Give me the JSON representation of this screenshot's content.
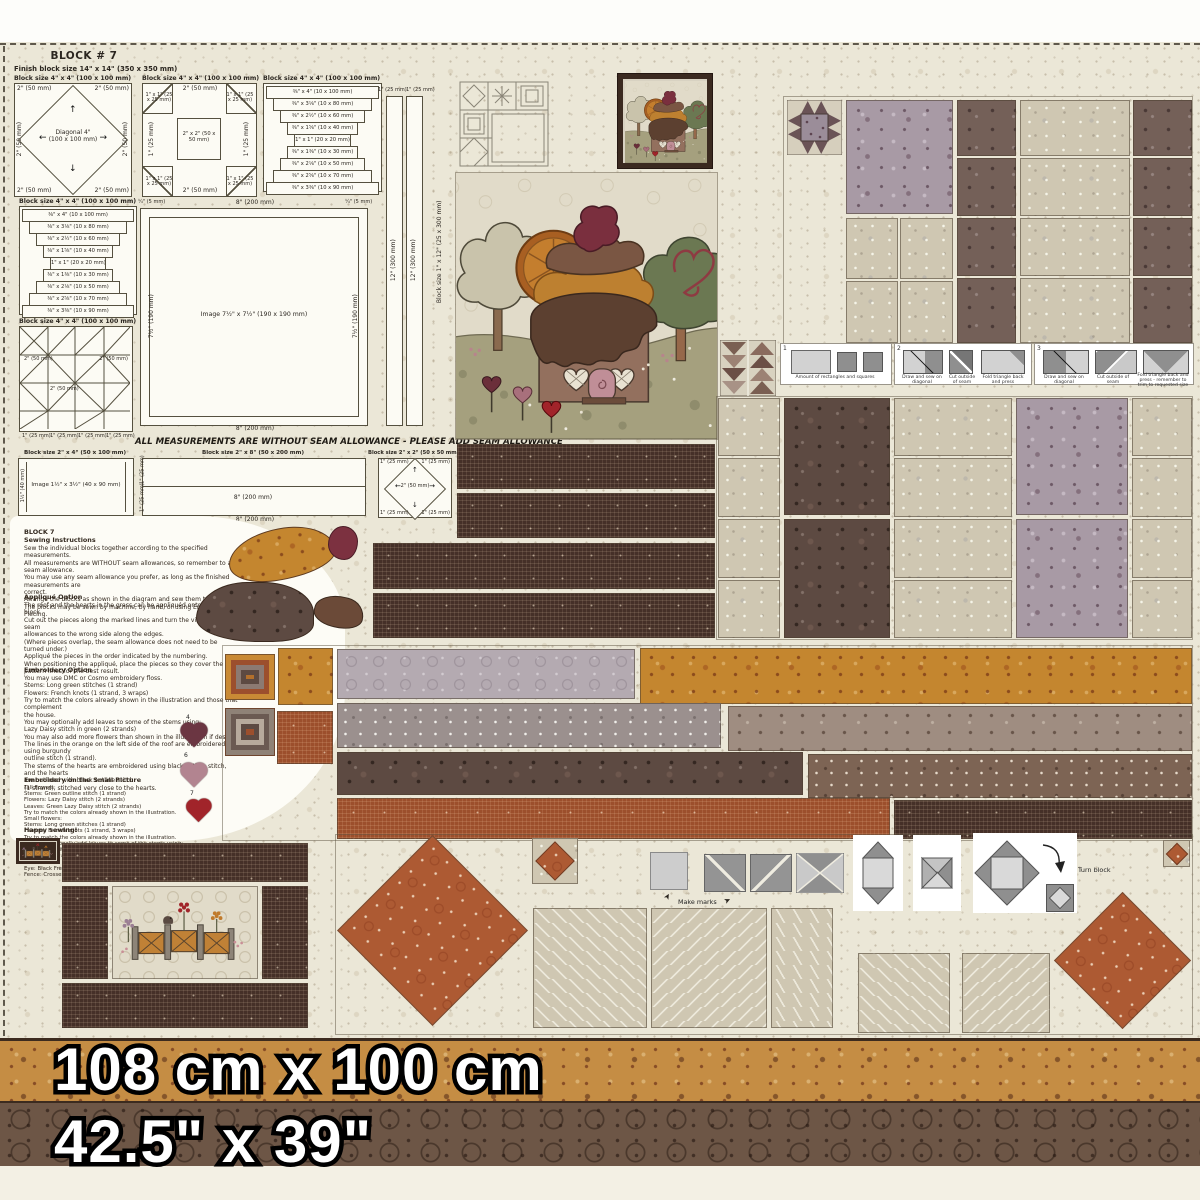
{
  "page": {
    "title": "BLOCK # 7",
    "subtitle": "Finish block size 14\" x 14\"  (350 x 350 mm)",
    "seam_notice": "ALL MEASUREMENTS ARE WITHOUT SEAM ALLOWANCE - PLEASE ADD SEAM ALLOWANCE",
    "size_metric": "108 cm x 100 cm",
    "size_imperial": "42.5\" x 39\""
  },
  "labels": {
    "block_4x4": "Block size 4\" x 4\"   (100 x 100 mm)",
    "block_2x4": "Block size 2\" x 4\"   (50 x 100 mm)",
    "block_2x8": "Block size 2\" x 8\"   (50 x 200 mm)",
    "block_2x2": "Block size 2\" x 2\"   (50 x 50 mm)",
    "block_1x12": "Block size 1\" x 12\"  (25 x 300 mm)",
    "diagonal_in": "Diagonal 4\"",
    "diagonal_mm": "(100 x 100 mm)",
    "m_2in": "2\"  (50 mm)",
    "m_1in": "1\" (25 mm)",
    "m_1x1": "1\" x 1\" (25 x 25 mm)",
    "m_2x2": "2\" x 2\"  (50 x 50 mm)",
    "m_8in": "8\"  (200 mm)",
    "m_12in": "12\"  (300 mm)",
    "m_quarter": "¼\" (5 mm)",
    "m_7half": "7½\"  (190 mm)",
    "m_4in": "4\"  (100 mm)",
    "m_1half": "1½\" (40 mm)",
    "image_main": "Image  7½\" x 7½\"  (190 x 190 mm)",
    "image_small": "Image  1½\" x 3½\"  (40 x 90 mm)",
    "lc0": "⅜\" x 4\"  (10 x 100 mm)",
    "lc1": "⅜\" x 3⅛\"  (10 x 80 mm)",
    "lc2": "⅜\" x 2½\"  (10 x 60 mm)",
    "lc3": "⅜\" x 1⅝\"  (10 x 40 mm)",
    "lc4": "1\" x 1\"  (20 x 20 mm)",
    "lc5": "⅜\" x 1⅜\"  (10 x 30 mm)",
    "lc6": "⅜\" x 2⅛\"  (10 x 50 mm)",
    "lc7": "⅜\" x 2⅝\"  (10 x 70 mm)",
    "lc8": "⅜\" x 3⅜\"  (10 x 90 mm)"
  },
  "steps": {
    "s1_num": "1",
    "s1_caption": "Amount of rectangles and squares",
    "s2_num": "2",
    "s2a": "Draw and sew on diagonal",
    "s2b": "Cut outside of seam",
    "s2c": "Fold triangle back and press",
    "s3_num": "3",
    "s3a": "Draw and sew on diagonal",
    "s3b": "Cut outside of seam",
    "s3c": "Fold triangle back and press - remember to trim to requested size",
    "make_marks": "Make marks",
    "turn_block": "Turn block"
  },
  "icons": {
    "arrow_up": "↑",
    "arrow_down": "↓",
    "arrow_left": "←",
    "arrow_right": "→",
    "pointer": "➤"
  },
  "instructions": {
    "heading": "BLOCK 7",
    "sewing_title": "Sewing Instructions",
    "sewing_lines": [
      "Sew the individual blocks together according to the specified measurements.",
      "All measurements are WITHOUT seam allowances, so remember to add seam allowance.",
      "You may use any seam allowance you prefer, as long as the finished measurements are",
      "correct.",
      "Arrange the blocks as shown in the diagram and sew them together.",
      "The blocks may be sewn by machine, by hand, or using English Paper Piecing."
    ],
    "applique_title": "Appliqué Option",
    "applique_lines": [
      "The roof and the hearts in the grass can be appliquéd onto the block.",
      "Cut out the pieces along the marked lines and turn the visible seam",
      "allowances to the wrong side along the edges.",
      "(Where pieces overlap, the seam allowance does not need to be",
      "turned under.)",
      "Appliqué the pieces in the order indicated by the numbering.",
      "When positioning the appliqué, place the pieces so they cover the",
      "pattern lines for the best result."
    ],
    "embroidery_title": "Embroidery Option",
    "embroidery_lines": [
      "You may use DMC or Cosmo embroidery floss.",
      "Stems: Long green stitches (1 strand)",
      "Flowers: French knots (1 strand, 3 wraps)",
      "Try to match the colors already shown in the illustration and those that complement",
      "the house.",
      "You may optionally add leaves to some of the stems using:",
      "Lazy Daisy stitch in green (2 strands)",
      "You may also add more flowers than shown in the illustration if desired.",
      "The lines in the orange on the left side of the roof are embroidered using burgundy",
      "outline stitch (1 strand).",
      "The stems of the hearts are embroidered using black outline stitch, and the hearts",
      "are outlined with black outline stitch",
      "(1 strand), stitched very close to the hearts."
    ],
    "small_picture_title": "Embroidery on the Small Picture",
    "small_picture_lines": [
      "Tall flowers:",
      "Stems: Green outline stitch (1 strand)",
      "Flowers: Lazy Daisy stitch (2 strands)",
      "Leaves: Green Lazy Daisy stitch (2 strands)",
      "Try to match the colors already shown in the illustration.",
      "Small flowers:",
      "Stems: Long green stitches (1 strand)",
      "Flowers: French knots (1 strand, 3 wraps)",
      "Try to match the colors already shown in the illustration.",
      "You may optionally add leaves to some of the stems using:",
      "Lazy Daisy stitch in green (2 strands)",
      "You may also add more flowers than shown in the illustration if desired.",
      "Bird:",
      "Eye: Black French knot (1 strand, 2 wraps)",
      "Fence: Crosses: Black outline stitch (1 strand)"
    ],
    "closing": "Happy sewing!"
  },
  "hearts": [
    {
      "num": "4",
      "color": "#6b3642"
    },
    {
      "num": "6",
      "color": "#b28490"
    },
    {
      "num": "7",
      "color": "#a1242a"
    }
  ],
  "colors": {
    "cream_bg": "#ebe7d7",
    "dark_woven": "#453028",
    "rust": "#ad5a33",
    "orange_floral": "#c4862f",
    "mauve_floral": "#a89aa5",
    "grass": "#a6a281",
    "border_orange": "#c58d44",
    "border_brown": "#6d5646"
  }
}
